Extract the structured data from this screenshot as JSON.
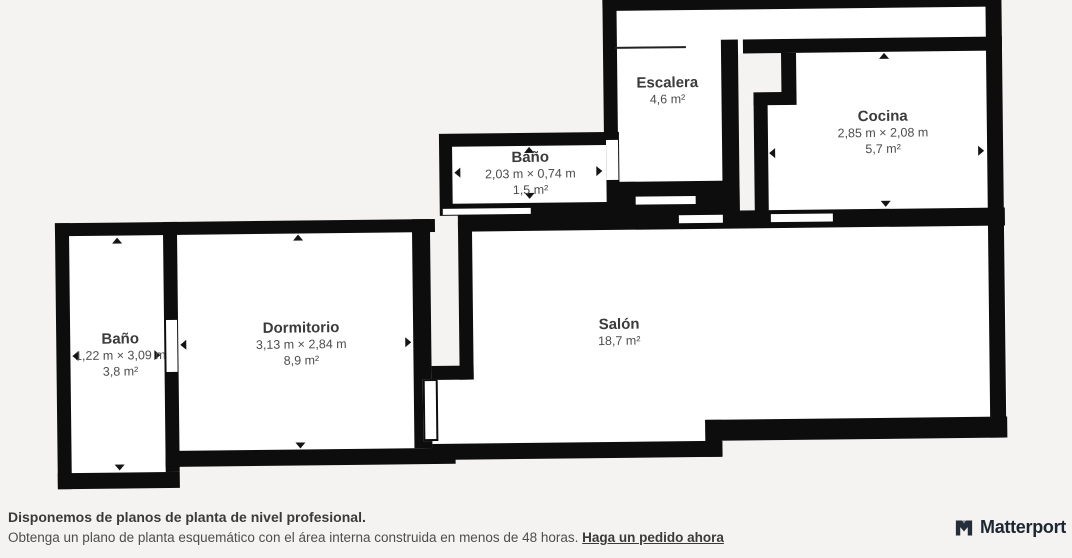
{
  "page": {
    "background_color": "#f4f3f1",
    "wall_color": "#0d0d0d",
    "room_fill_color": "#ffffff",
    "label_color": "#3b3b3b",
    "dims_color": "#4d4d4d"
  },
  "floorplan": {
    "rooms": [
      {
        "id": "escalera",
        "name": "Escalera",
        "area": "4,6 m²"
      },
      {
        "id": "cocina",
        "name": "Cocina",
        "dimensions": "2,85 m × 2,08 m",
        "area": "5,7 m²"
      },
      {
        "id": "bano-superior",
        "name": "Baño",
        "dimensions": "2,03 m × 0,74 m",
        "area": "1,5 m²"
      },
      {
        "id": "bano-izquierdo",
        "name": "Baño",
        "dimensions": "1,22 m × 3,09 m",
        "area": "3,8 m²"
      },
      {
        "id": "dormitorio",
        "name": "Dormitorio",
        "dimensions": "3,13 m × 2,84 m",
        "area": "8,9 m²"
      },
      {
        "id": "salon",
        "name": "Salón",
        "area": "18,7 m²"
      }
    ]
  },
  "footer": {
    "headline": "Disponemos de planos de planta de nivel profesional.",
    "body": "Obtenga un plano de planta esquemático con el área interna construida en menos de 48 horas.",
    "link_label": "Haga un pedido ahora",
    "brand_name": "Matterport",
    "brand_color": "#1d2733"
  }
}
